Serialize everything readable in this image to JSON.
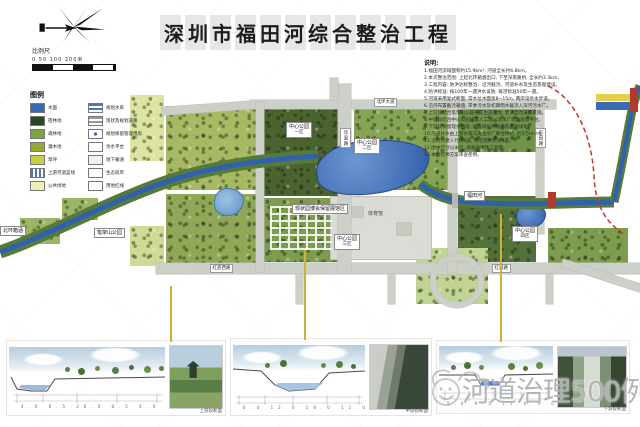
{
  "title": "深圳市福田河综合整治工程",
  "scale_bar": {
    "label": "比例尺",
    "ticks": "0    50   100        200米"
  },
  "legend": {
    "header": "图例",
    "col1": [
      {
        "label": "水面",
        "color": "#3a68b0",
        "pattern": "solid"
      },
      {
        "label": "密林地",
        "color": "#264a20",
        "pattern": "solid"
      },
      {
        "label": "疏林地",
        "color": "#79a43e",
        "pattern": "solid"
      },
      {
        "label": "灌木地",
        "color": "#98a635",
        "pattern": "solid"
      },
      {
        "label": "草坪",
        "color": "#c9cf45",
        "pattern": "solid"
      },
      {
        "label": "上游河道蓝线",
        "color": "#4a74b8",
        "pattern": "vstripe"
      },
      {
        "label": "公共绿地",
        "color": "#eff0b4",
        "pattern": "solid"
      }
    ],
    "col2": [
      {
        "label": "规划水系",
        "color": "#4a74b8",
        "pattern": "hstripe"
      },
      {
        "label": "现状及规划道路",
        "color": "#9a9a9a",
        "pattern": "hstripe"
      },
      {
        "label": "规划保留管理用房",
        "color": "#4a74b8",
        "pattern": "dot"
      },
      {
        "label": "亲水平台",
        "color": "#cccccc",
        "pattern": "outline"
      },
      {
        "label": "地下箱涵",
        "color": "#e8e8dd",
        "pattern": "faint"
      },
      {
        "label": "生态驳岸",
        "color": "#cccccc",
        "pattern": "outline"
      },
      {
        "label": "用地红线",
        "color": "#cccccc",
        "pattern": "outline"
      }
    ]
  },
  "map": {
    "area_labels": [
      {
        "text": "中心公园",
        "sub": "一区"
      },
      {
        "text": "中心公园",
        "sub": "二区"
      },
      {
        "text": "中心公园",
        "sub": "三区"
      },
      {
        "text": "中心公园",
        "sub": "四区"
      },
      {
        "text": "笔架山公园"
      },
      {
        "text": "现状园博会保留展馆区"
      },
      {
        "text": "体育馆"
      },
      {
        "text": "北环箱涵"
      },
      {
        "text": "福田河"
      }
    ],
    "road_labels": [
      {
        "text": "北环大道"
      },
      {
        "text": "红荔西路"
      },
      {
        "text": "红荔路"
      },
      {
        "text": "华富路"
      },
      {
        "text": "彩田路"
      }
    ]
  },
  "notes": {
    "header": "说明:",
    "lines": [
      "1.福田河流域面积约15.9km², 河道全长约6.8km。",
      "2.本次整治范围: 上起北环箱涵出口, 下至深南路桥, 全长约3.3km。",
      "3.工程内容: 防洪达标整治、沿河截污、河道补水及生态景观建设。",
      "4.防洪标准: 按100年一遇洪水设防, 排涝标准50年一遇。",
      "5.河道采用复式断面, 常水位水面宽8~15m, 两岸设亲水步道。",
      "6.沿河布置截污箱涵, 旱季污水及初期雨水截流入滨河污水厂。",
      "7.上游段结合笔架山公园布置生态湿地, 营造自然溪流景观。",
      "8.中游段结合中心公园设置人工湖、滨水广场及观景平台。",
      "9.下游段保留现状挡墙, 增设绿化种植槽及垂直绿化。",
      "10.河道补水由上游水库与再生水厂联合供给, 约5万m³/d。",
      "11.沿河新建人行桥4座, 改造现状桥梁6座。",
      "12.图中尺寸以米计, 高程采用珠江基面。",
      "13.本图仅供方案审查使用。"
    ]
  },
  "sections": [
    {
      "dims": "4.0   8.5   26.0   8.5   4.0",
      "caption": "上游段断面"
    },
    {
      "dims": "6.0   12.0   18.0   12.0   6.0",
      "caption": "中游段断面"
    },
    {
      "dims": "5.0   9.0   15.0   9.0   5.0",
      "caption": "下游段断面"
    }
  ],
  "watermark": {
    "text": "河道治理500例"
  },
  "colors": {
    "water": "#3a6cb4",
    "road": "#cdcfc9",
    "boundary_red": "#c0392b",
    "leader_yellow": "#c9b33a"
  }
}
